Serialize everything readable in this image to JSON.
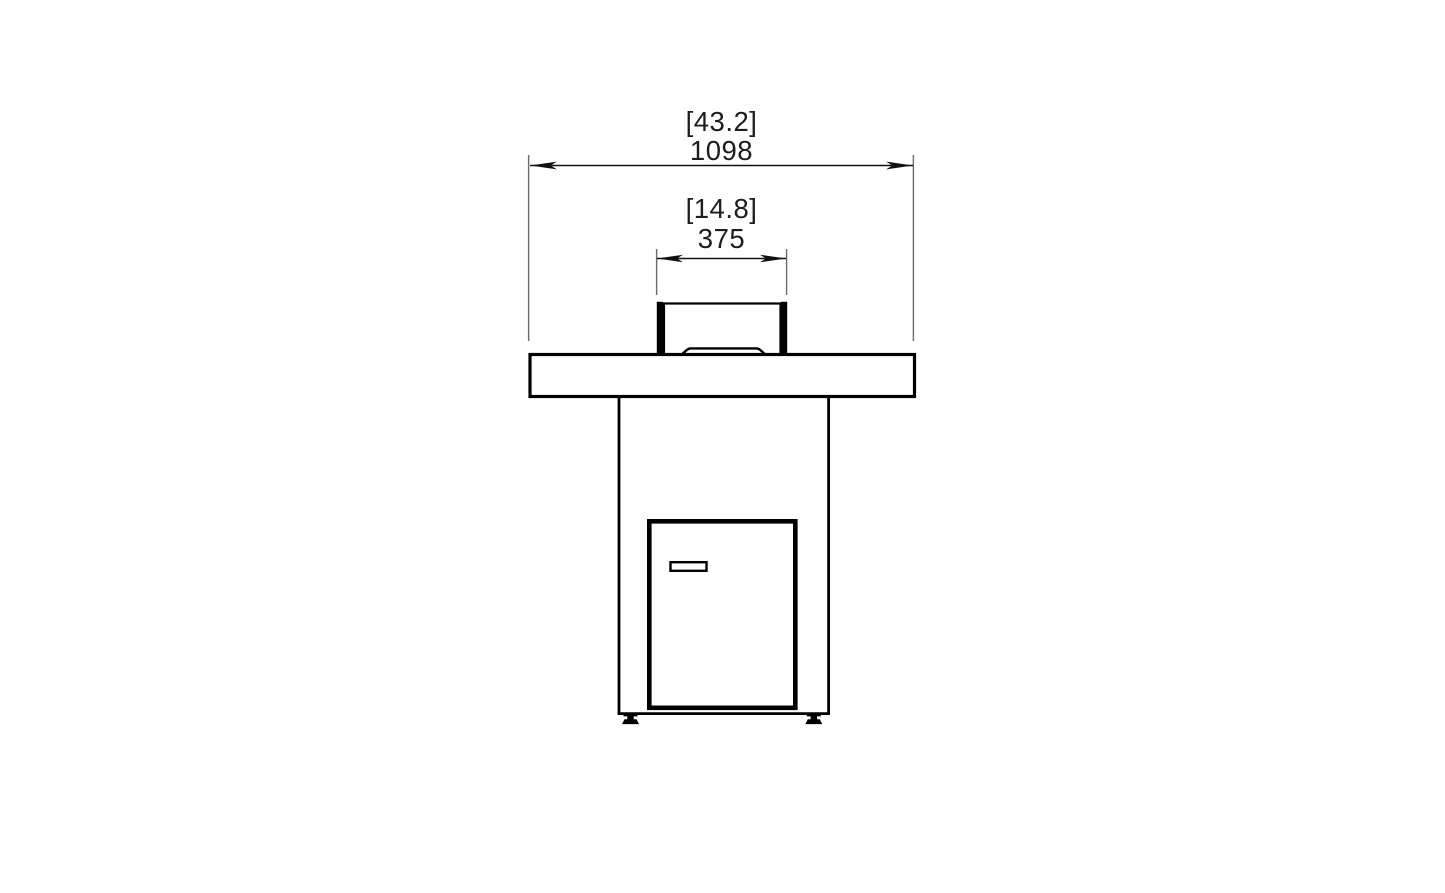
{
  "drawing": {
    "view": "front-elevation",
    "dimensions": [
      {
        "id": "overall-width",
        "inches_label": "[43.2]",
        "mm_label": "1098"
      },
      {
        "id": "burner-width",
        "inches_label": "[14.8]",
        "mm_label": "375"
      }
    ],
    "colors": {
      "line": "#000000",
      "extension_line": "#6a6a6a",
      "text": "#1d1d1d",
      "background": "#ffffff"
    }
  }
}
